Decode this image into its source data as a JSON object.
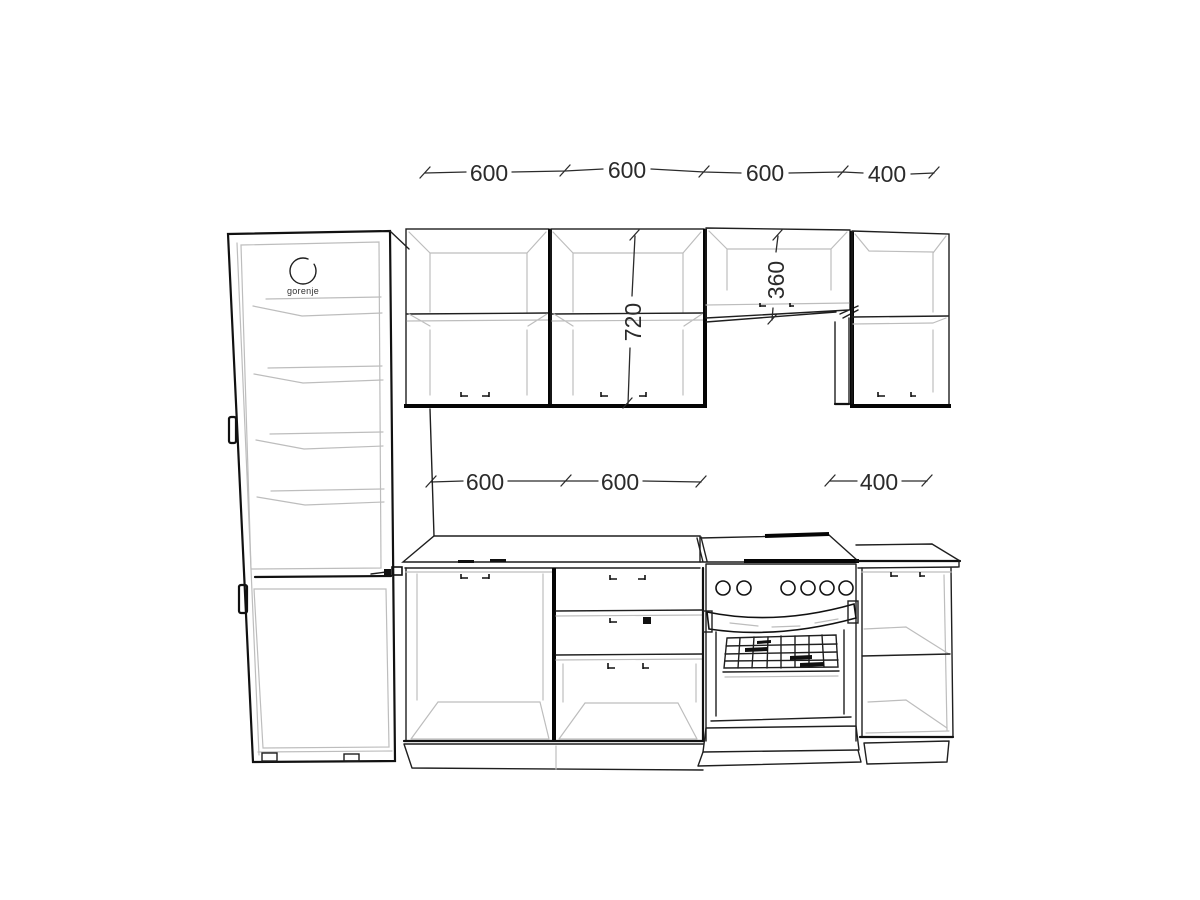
{
  "drawing": {
    "type": "kitchen elevation line drawing",
    "brand": "gorenje",
    "dims_top": [
      "600",
      "600",
      "600",
      "400"
    ],
    "dims_mid": [
      "600",
      "600",
      "400"
    ],
    "dim_height_tall": "720",
    "dim_height_short": "360"
  },
  "colors": {
    "background": "#ffffff",
    "main_line": "#1f1f1f",
    "light_line": "#bdbdbd",
    "dimension_text": "#2b2b2b"
  }
}
